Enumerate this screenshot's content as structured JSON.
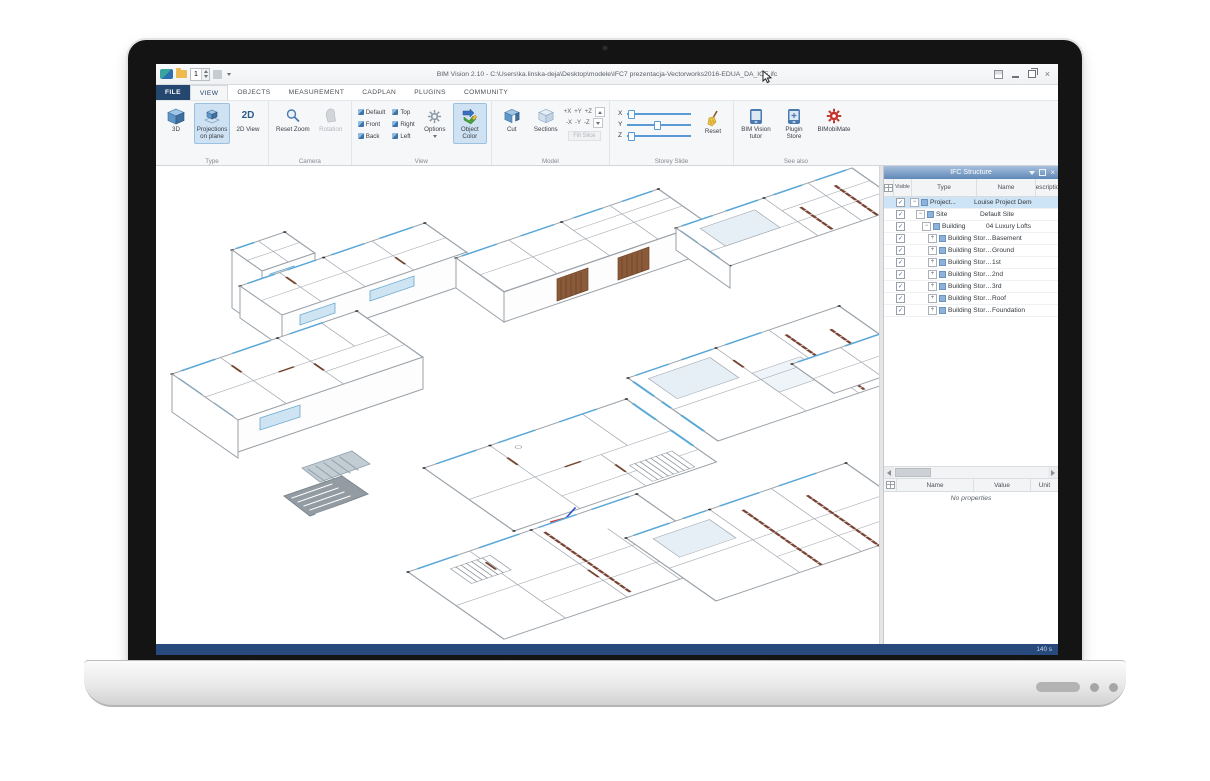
{
  "window": {
    "title": "BIM Vision 2.10 - C:\\Users\\ka.linska-deja\\Desktop\\modele\\IFC7 prezentacja-Vectorworks2016-EDUA_DA_ICE.ifc",
    "quick_access_value": "1",
    "status_right": "140 s"
  },
  "tabs": {
    "selected": "VIEW",
    "items": [
      "FILE",
      "VIEW",
      "OBJECTS",
      "MEASUREMENT",
      "CADPLAN",
      "PLUGINS",
      "COMMUNITY"
    ]
  },
  "ribbon": {
    "groups": [
      {
        "name": "Type",
        "buttons": [
          {
            "label": "3D"
          },
          {
            "label": "Projections on plane",
            "selected": true
          },
          {
            "label": "2D View"
          }
        ]
      },
      {
        "name": "Camera",
        "buttons": [
          {
            "label": "Reset Zoom"
          },
          {
            "label": "Rotation",
            "disabled": true
          }
        ]
      },
      {
        "name": "View",
        "view_buttons": [
          "Default",
          "Front",
          "Back",
          "Top",
          "Right",
          "Left"
        ],
        "buttons": [
          {
            "label": "Options"
          },
          {
            "label": "Object Color",
            "selected": true
          }
        ]
      },
      {
        "name": "Model",
        "buttons": [
          {
            "label": "Cut"
          },
          {
            "label": "Sections"
          }
        ],
        "axis_buttons": [
          "+X",
          "+Y",
          "+Z",
          "-X",
          "-Y",
          "-Z"
        ],
        "fill_slice": "Fill Slice"
      },
      {
        "name": "Storey Slide",
        "sliders": [
          {
            "axis": "X",
            "value": 4
          },
          {
            "axis": "Y",
            "value": 46
          },
          {
            "axis": "Z",
            "value": 4
          }
        ],
        "reset_label": "Reset"
      },
      {
        "name": "See also",
        "buttons": [
          {
            "label": "BIM Vision tutor"
          },
          {
            "label": "Plugin Store"
          },
          {
            "label": "BIMobiMate"
          }
        ]
      }
    ]
  },
  "structure_panel": {
    "title": "IFC Structure",
    "columns": [
      "",
      "Visible",
      "Type",
      "Name",
      "Description"
    ],
    "rows": [
      {
        "level": 0,
        "expanded": true,
        "checked": true,
        "selected": true,
        "type": "Project...",
        "name": "Louise Project Demo"
      },
      {
        "level": 1,
        "expanded": true,
        "checked": true,
        "type": "Site",
        "name": "Default Site"
      },
      {
        "level": 2,
        "expanded": true,
        "checked": true,
        "type": "Building",
        "name": "04 Luxury Lofts"
      },
      {
        "level": 3,
        "expanded": false,
        "checked": true,
        "type": "Building Storey",
        "name": "Basement"
      },
      {
        "level": 3,
        "expanded": false,
        "checked": true,
        "type": "Building Storey",
        "name": "Ground"
      },
      {
        "level": 3,
        "expanded": false,
        "checked": true,
        "type": "Building Storey",
        "name": "1st"
      },
      {
        "level": 3,
        "expanded": false,
        "checked": true,
        "type": "Building Storey",
        "name": "2nd"
      },
      {
        "level": 3,
        "expanded": false,
        "checked": true,
        "type": "Building Storey",
        "name": "3rd"
      },
      {
        "level": 3,
        "expanded": false,
        "checked": true,
        "type": "Building Storey",
        "name": "Roof"
      },
      {
        "level": 3,
        "expanded": false,
        "checked": true,
        "type": "Building Storey",
        "name": "Foundation"
      }
    ]
  },
  "properties_panel": {
    "columns": [
      "Name",
      "Value",
      "Unit"
    ],
    "empty_text": "No properties"
  },
  "colors": {
    "accent_blue": "#2b579a",
    "ribbon_selection": "#cfe2f3",
    "panel_header": "#6089b8",
    "status_bar": "#27497c",
    "window_glass": "#5aa8d8",
    "door_brown": "#74432f"
  }
}
